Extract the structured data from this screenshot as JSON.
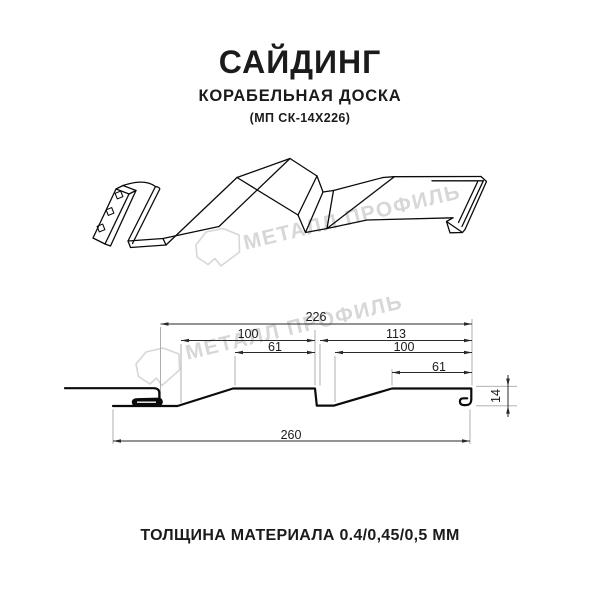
{
  "header": {
    "title": "САЙДИНГ",
    "subtitle": "КОРАБЕЛЬНАЯ ДОСКА",
    "model_code": "(МП СК-14Х226)"
  },
  "footer": {
    "text": "ТОЛЩИНА МАТЕРИАЛА 0.4/0,45/0,5 ММ"
  },
  "watermark": {
    "text": "МЕТАЛЛ ПРОФИЛЬ",
    "logo": "metall-profil-crystal-logo",
    "color": "#d7d7d7"
  },
  "drawing": {
    "type": "technical-profile-drawing",
    "views": [
      "3d-perspective-panel",
      "cross-section-with-dimensions"
    ],
    "dimensions": {
      "overall": "226",
      "left_module": "100",
      "left_flat": "61",
      "right_module": "113",
      "right_lower": "100",
      "right_flat": "61",
      "total": "260",
      "depth": "14"
    },
    "colors": {
      "line": "#0b0b0b",
      "dimension": "#2a2a2a",
      "extension": "#a6a6a6",
      "watermark": "#d7d7d7"
    }
  }
}
